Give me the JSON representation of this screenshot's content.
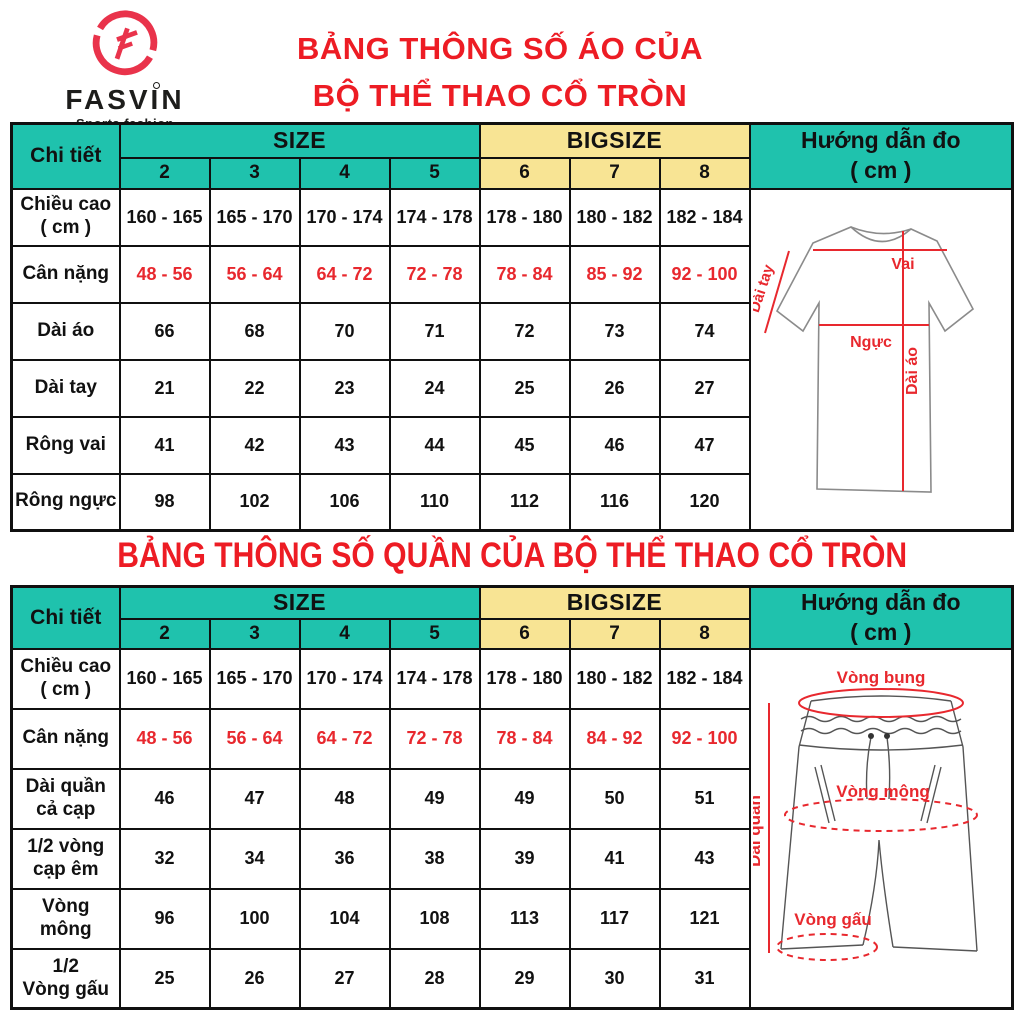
{
  "brand": {
    "name": "FASVIN",
    "tagline": "Sports fashion"
  },
  "colors": {
    "teal": "#1FC2AD",
    "yellow": "#F8E494",
    "title_red": "#ED1C24",
    "value_red": "#E8282E",
    "logo_red": "#E9334B"
  },
  "titles": {
    "shirt_line1": "BẢNG THÔNG SỐ ÁO CỦA",
    "shirt_line2": "BỘ THỂ THAO CỔ TRÒN",
    "pants": "BẢNG THÔNG SỐ QUẦN CỦA BỘ THỂ THAO CỔ TRÒN"
  },
  "shirt_table": {
    "corner": "Chi tiết",
    "size": "SIZE",
    "bigsize": "BIGSIZE",
    "guide_line1": "Hướng dẫn đo",
    "guide_line2": "( cm )",
    "size_cols": [
      "2",
      "3",
      "4",
      "5"
    ],
    "bigsize_cols": [
      "6",
      "7",
      "8"
    ],
    "rows": [
      {
        "label": "Chiều cao\n( cm )",
        "values": [
          "160 - 165",
          "165 - 170",
          "170 - 174",
          "174 - 178",
          "178 - 180",
          "180 - 182",
          "182 - 184"
        ]
      },
      {
        "label": "Cân nặng",
        "red": true,
        "values": [
          "48 - 56",
          "56 - 64",
          "64 - 72",
          "72 - 78",
          "78 - 84",
          "85 - 92",
          "92 - 100"
        ]
      },
      {
        "label": "Dài áo",
        "values": [
          "66",
          "68",
          "70",
          "71",
          "72",
          "73",
          "74"
        ]
      },
      {
        "label": "Dài tay",
        "values": [
          "21",
          "22",
          "23",
          "24",
          "25",
          "26",
          "27"
        ]
      },
      {
        "label": "Rông vai",
        "values": [
          "41",
          "42",
          "43",
          "44",
          "45",
          "46",
          "47"
        ]
      },
      {
        "label": "Rông ngực",
        "values": [
          "98",
          "102",
          "106",
          "110",
          "112",
          "116",
          "120"
        ]
      }
    ],
    "diagram": {
      "shoulder": "Vai",
      "chest": "Ngực",
      "length": "Dài áo",
      "sleeve": "Dài tay"
    }
  },
  "pants_table": {
    "corner": "Chi tiết",
    "size": "SIZE",
    "bigsize": "BIGSIZE",
    "guide_line1": "Hướng dẫn đo",
    "guide_line2": "( cm )",
    "size_cols": [
      "2",
      "3",
      "4",
      "5"
    ],
    "bigsize_cols": [
      "6",
      "7",
      "8"
    ],
    "rows": [
      {
        "label": "Chiều cao\n( cm )",
        "values": [
          "160 - 165",
          "165 - 170",
          "170 - 174",
          "174 - 178",
          "178 - 180",
          "180 - 182",
          "182 - 184"
        ]
      },
      {
        "label": "Cân nặng",
        "red": true,
        "values": [
          "48 - 56",
          "56 - 64",
          "64 - 72",
          "72 - 78",
          "78 - 84",
          "84 - 92",
          "92 - 100"
        ]
      },
      {
        "label": "Dài quần\ncả cạp",
        "values": [
          "46",
          "47",
          "48",
          "49",
          "49",
          "50",
          "51"
        ]
      },
      {
        "label": "1/2 vòng\ncạp êm",
        "values": [
          "32",
          "34",
          "36",
          "38",
          "39",
          "41",
          "43"
        ]
      },
      {
        "label": "Vòng\nmông",
        "values": [
          "96",
          "100",
          "104",
          "108",
          "113",
          "117",
          "121"
        ]
      },
      {
        "label": "1/2\nVòng gấu",
        "values": [
          "25",
          "26",
          "27",
          "28",
          "29",
          "30",
          "31"
        ]
      }
    ],
    "diagram": {
      "waist": "Vòng bụng",
      "hip": "Vòng mông",
      "hem": "Vòng gấu",
      "length": "Dài quần"
    }
  }
}
